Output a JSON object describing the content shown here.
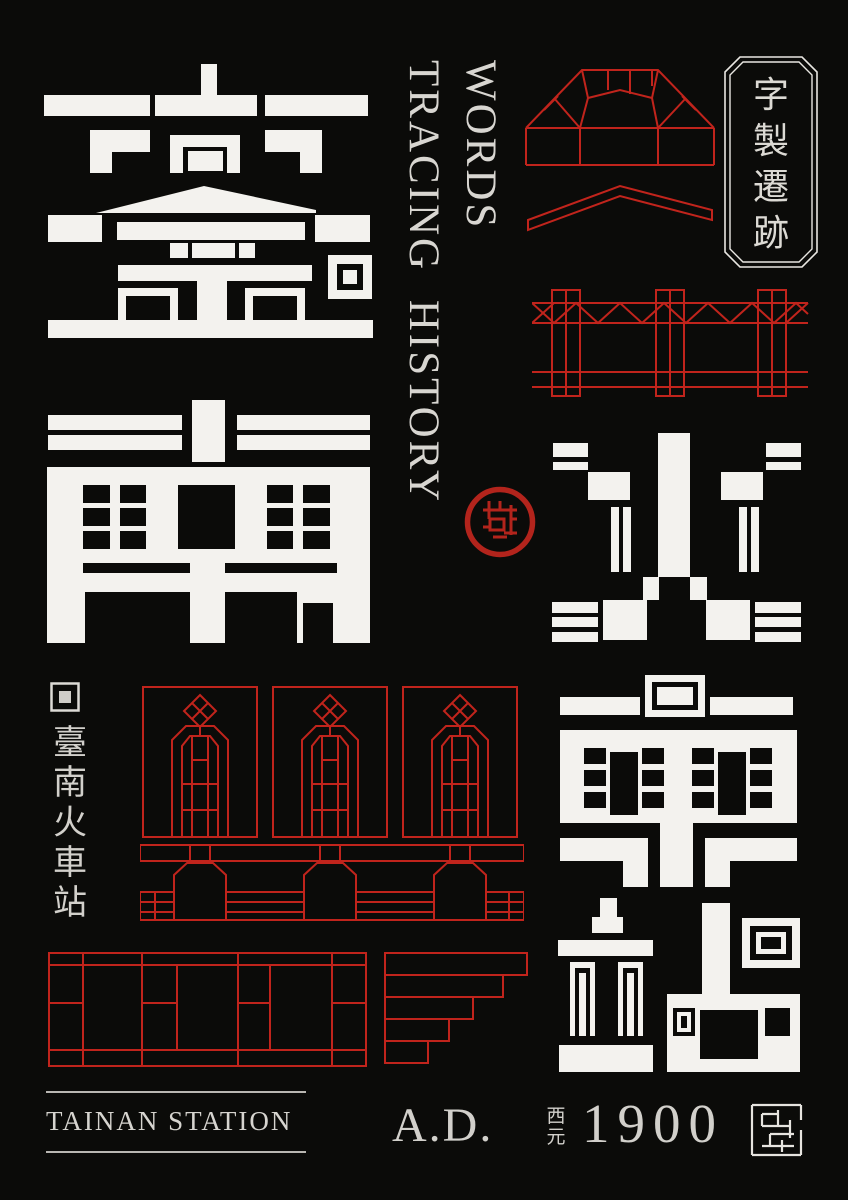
{
  "colors": {
    "background": "#0b0b09",
    "line_red": "#c1241c",
    "seal_red": "#b3241c",
    "glyph_white": "#f3f2ee",
    "text_light": "#d6d4cf"
  },
  "big_glyphs": {
    "chars": [
      "臺",
      "南",
      "火",
      "車",
      "站"
    ]
  },
  "english_title": {
    "line1": "WORDS",
    "line2": "TRACING HISTORY"
  },
  "plaque": {
    "chars": [
      "字",
      "製",
      "遷",
      "跡"
    ]
  },
  "side_caption": {
    "chars": [
      "臺",
      "南",
      "火",
      "車",
      "站"
    ]
  },
  "footer": {
    "station_name": "TAINAN STATION",
    "era_prefix": "A.D.",
    "era_top": "西",
    "era_bottom": "元",
    "year": "1900",
    "builder_mark": "建"
  }
}
